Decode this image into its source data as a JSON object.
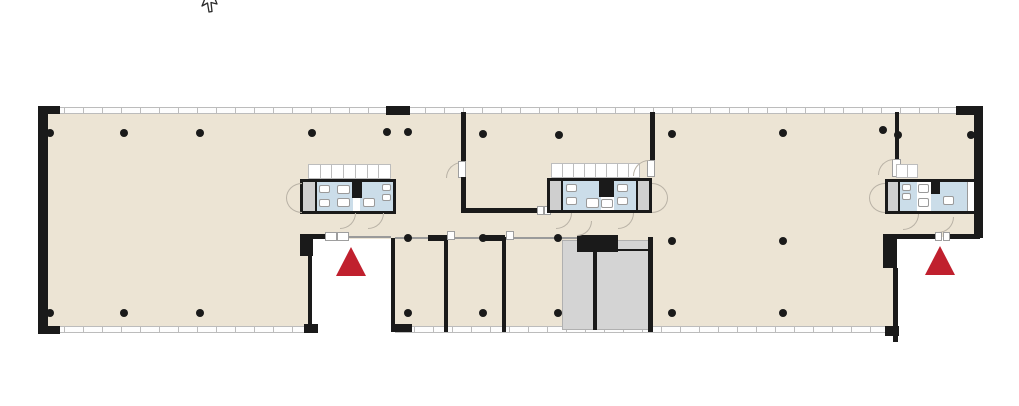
{
  "viewer": {
    "background": "#ffffff",
    "cursor": {
      "icon": "arrow-pointer",
      "x": 199,
      "y": -8
    }
  },
  "floor_plan": {
    "kind": "office-building-floor-plan",
    "colors": {
      "floor": "#ece4d4",
      "wet_room": "#cbdde9",
      "service_gray": "#cfcfcf",
      "stair_gray": "#d4d4d4",
      "wall": "#1a1a1a",
      "window_frame": "#bcbcbc",
      "entrance_marker": "#c0202e",
      "door_swing": "#b9b2a6",
      "fixture_border": "#9a9a9a",
      "corridor_line": "#9a9a9a",
      "background": "#ffffff"
    },
    "legend": {
      "entrance_marker_shape": "red-triangle",
      "entrance_count": 2,
      "restroom_core_count": 3,
      "stairwell_count": 1
    },
    "columns": {
      "top_row": [
        [
          50,
          133
        ],
        [
          124,
          133
        ],
        [
          200,
          133
        ],
        [
          312,
          133
        ],
        [
          387,
          132
        ],
        [
          408,
          132
        ],
        [
          483,
          134
        ],
        [
          559,
          135
        ],
        [
          672,
          134
        ],
        [
          783,
          133
        ],
        [
          883,
          130
        ],
        [
          898,
          135
        ],
        [
          971,
          135
        ]
      ],
      "middle_row": [
        [
          408,
          238
        ],
        [
          483,
          238
        ],
        [
          558,
          238
        ],
        [
          672,
          241
        ],
        [
          783,
          241
        ]
      ],
      "bottom_row": [
        [
          50,
          313
        ],
        [
          124,
          313
        ],
        [
          200,
          313
        ],
        [
          408,
          313
        ],
        [
          483,
          313
        ],
        [
          558,
          313
        ],
        [
          672,
          313
        ],
        [
          783,
          313
        ]
      ]
    },
    "entrance_markers": [
      {
        "x": 351,
        "y": 247
      },
      {
        "x": 940,
        "y": 246
      }
    ]
  }
}
